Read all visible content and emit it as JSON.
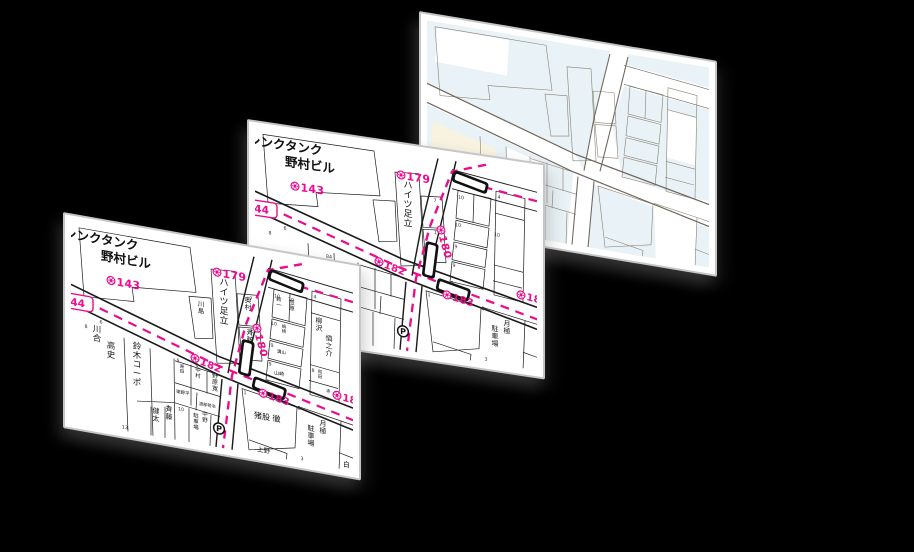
{
  "colors": {
    "background": "#000000",
    "card_face": "#ffffff",
    "card_edge": "#c6c6c6",
    "map_ink": "#1a1a1a",
    "boundary_magenta": "#ec0b8d",
    "base_block_blue": "#e9f2f6",
    "base_block_cream": "#f7f3e0",
    "base_line_gray": "#8a8073",
    "base_road_gray": "#6f675c"
  },
  "icons": {
    "parking": "circled-P",
    "block_marker": "circled-flower-stamp"
  },
  "maps": {
    "front": {
      "pink": [
        {
          "t": "143",
          "x": 40,
          "y": 52,
          "s": 11
        },
        {
          "t": "144",
          "x": 2,
          "y": 73,
          "s": 10.5,
          "box": true
        },
        {
          "t": "179",
          "x": 146,
          "y": 25,
          "s": 11
        },
        {
          "t": "180",
          "x": 186,
          "y": 74,
          "s": 10.5,
          "rot": 74
        },
        {
          "t": "182",
          "x": 124,
          "y": 115,
          "s": 10,
          "rot": 14
        },
        {
          "t": "183",
          "x": 192,
          "y": 138,
          "s": 10,
          "rot": 9
        },
        {
          "t": "18",
          "x": 266,
          "y": 127,
          "s": 10,
          "rot": 6
        }
      ],
      "black": [
        {
          "t": "シンクタンク",
          "x": -7,
          "y": 17,
          "s": 12.5,
          "mode": "h",
          "w": 700
        },
        {
          "t": "野村ビル",
          "x": 30,
          "y": 33,
          "s": 12.5,
          "mode": "h",
          "w": 700
        },
        {
          "t": "川島",
          "x": 130,
          "y": 62,
          "s": 6.5,
          "mode": "v"
        },
        {
          "t": "ハイツ足立",
          "x": 153,
          "y": 37,
          "s": 9,
          "mode": "v"
        },
        {
          "t": "奥村",
          "x": 177,
          "y": 50,
          "s": 7,
          "mode": "v"
        },
        {
          "t": "斉藤",
          "x": 179,
          "y": 82,
          "s": 7,
          "mode": "v"
        },
        {
          "t": "川合",
          "x": 26,
          "y": 106,
          "s": 8.5,
          "mode": "v"
        },
        {
          "t": "高史",
          "x": 40,
          "y": 120,
          "s": 8.5,
          "mode": "v"
        },
        {
          "t": "鈴木コーポ",
          "x": 66,
          "y": 116,
          "s": 8.5,
          "mode": "v"
        },
        {
          "t": "原田",
          "x": 111,
          "y": 127,
          "s": 4.5,
          "mode": "v"
        },
        {
          "t": "中村",
          "x": 127,
          "y": 128,
          "s": 5.5,
          "mode": "v"
        },
        {
          "t": "野原寛",
          "x": 144,
          "y": 131,
          "s": 6,
          "mode": "v"
        },
        {
          "t": "東野平",
          "x": 105,
          "y": 153,
          "s": 4.5,
          "mode": "h"
        },
        {
          "t": "渡部勢治",
          "x": 128,
          "y": 161,
          "s": 4.2,
          "mode": "h"
        },
        {
          "t": "健太",
          "x": 85,
          "y": 177,
          "s": 7,
          "mode": "v"
        },
        {
          "t": "斉藤",
          "x": 98,
          "y": 173,
          "s": 7,
          "mode": "v"
        },
        {
          "t": "駐車場",
          "x": 125,
          "y": 174,
          "s": 5.5,
          "mode": "v"
        },
        {
          "t": "中野",
          "x": 134,
          "y": 171,
          "s": 5.5,
          "mode": "v"
        },
        {
          "t": "猪股 徹",
          "x": 183,
          "y": 164,
          "s": 8,
          "mode": "h"
        },
        {
          "t": "上野",
          "x": 186,
          "y": 197,
          "s": 6.5,
          "mode": "h"
        },
        {
          "t": "駐車場",
          "x": 240,
          "y": 167,
          "s": 7,
          "mode": "v"
        },
        {
          "t": "月極",
          "x": 252,
          "y": 160,
          "s": 7,
          "mode": "v"
        },
        {
          "t": "白",
          "x": 272,
          "y": 197,
          "s": 7,
          "mode": "h"
        },
        {
          "t": "新一",
          "x": 208,
          "y": 43,
          "s": 5.5,
          "mode": "v"
        },
        {
          "t": "笠原",
          "x": 221,
          "y": 44,
          "s": 5.5,
          "mode": "v"
        },
        {
          "t": "嶋崎",
          "x": 213,
          "y": 69,
          "s": 4.5,
          "mode": "v"
        },
        {
          "t": "溝山",
          "x": 206,
          "y": 95,
          "s": 4.5,
          "mode": "h"
        },
        {
          "t": "山崎",
          "x": 203,
          "y": 117,
          "s": 5,
          "mode": "h"
        },
        {
          "t": "柳沢",
          "x": 248,
          "y": 58,
          "s": 7,
          "mode": "v"
        },
        {
          "t": "慎之介",
          "x": 258,
          "y": 74,
          "s": 7,
          "mode": "v"
        },
        {
          "t": "和田",
          "x": 249,
          "y": 108,
          "s": 4.5,
          "mode": "v"
        },
        {
          "t": "寺",
          "x": 255,
          "y": 126,
          "s": 4.5,
          "mode": "h"
        }
      ],
      "numbers": [
        [
          "6",
          30,
          97
        ],
        [
          "8",
          15,
          104
        ],
        [
          "13",
          54,
          198
        ],
        [
          "5",
          107,
          122
        ],
        [
          "8",
          126,
          123
        ],
        [
          "7",
          97,
          170
        ],
        [
          "10",
          110,
          170
        ],
        [
          "7",
          180,
          47
        ],
        [
          "11",
          182,
          79
        ],
        [
          "10",
          206,
          40
        ],
        [
          "10",
          220,
          41
        ],
        [
          "10",
          203,
          68
        ],
        [
          "9",
          201,
          90
        ],
        [
          "9",
          199,
          109
        ],
        [
          "8",
          197,
          127
        ],
        [
          "4",
          244,
          34
        ],
        [
          "8",
          242,
          108
        ],
        [
          "1",
          174,
          142
        ],
        [
          "3",
          231,
          198
        ],
        [
          "8",
          228,
          148
        ]
      ],
      "parking": {
        "x": 148,
        "y": 181
      }
    },
    "middle": {
      "pink": [
        {
          "t": "143",
          "x": 40,
          "y": 52,
          "s": 11
        },
        {
          "t": "144",
          "x": 2,
          "y": 73,
          "s": 10.5,
          "box": true
        },
        {
          "t": "179",
          "x": 146,
          "y": 25,
          "s": 11
        },
        {
          "t": "180",
          "x": 186,
          "y": 74,
          "s": 10.5,
          "rot": 74
        },
        {
          "t": "182",
          "x": 124,
          "y": 115,
          "s": 10,
          "rot": 14
        },
        {
          "t": "183",
          "x": 192,
          "y": 138,
          "s": 10,
          "rot": 9
        },
        {
          "t": "18",
          "x": 266,
          "y": 127,
          "s": 10,
          "rot": 6
        }
      ],
      "black": [
        {
          "t": "シンクタンク",
          "x": -7,
          "y": 17,
          "s": 12.5,
          "mode": "h",
          "w": 700
        },
        {
          "t": "野村ビル",
          "x": 30,
          "y": 33,
          "s": 12.5,
          "mode": "h",
          "w": 700
        },
        {
          "t": "ハイツ足立",
          "x": 153,
          "y": 37,
          "s": 9,
          "mode": "v"
        },
        {
          "t": "駐車場",
          "x": 240,
          "y": 167,
          "s": 7,
          "mode": "v"
        },
        {
          "t": "月極",
          "x": 252,
          "y": 160,
          "s": 7,
          "mode": "v"
        }
      ],
      "numbers": [
        [
          "6",
          30,
          97
        ],
        [
          "8",
          15,
          104
        ],
        [
          "84",
          74,
          119
        ],
        [
          "7",
          180,
          47
        ],
        [
          "11",
          182,
          79
        ],
        [
          "10",
          206,
          40
        ],
        [
          "10",
          203,
          68
        ],
        [
          "9",
          201,
          90
        ],
        [
          "9",
          199,
          109
        ],
        [
          "8",
          197,
          127
        ],
        [
          "4",
          244,
          34
        ],
        [
          "10",
          242,
          72
        ],
        [
          "1",
          174,
          142
        ],
        [
          "3",
          231,
          198
        ],
        [
          "8",
          228,
          148
        ]
      ],
      "parking": {
        "x": 148,
        "y": 181
      }
    },
    "back": {
      "pink": [],
      "black": [],
      "numbers": []
    }
  }
}
